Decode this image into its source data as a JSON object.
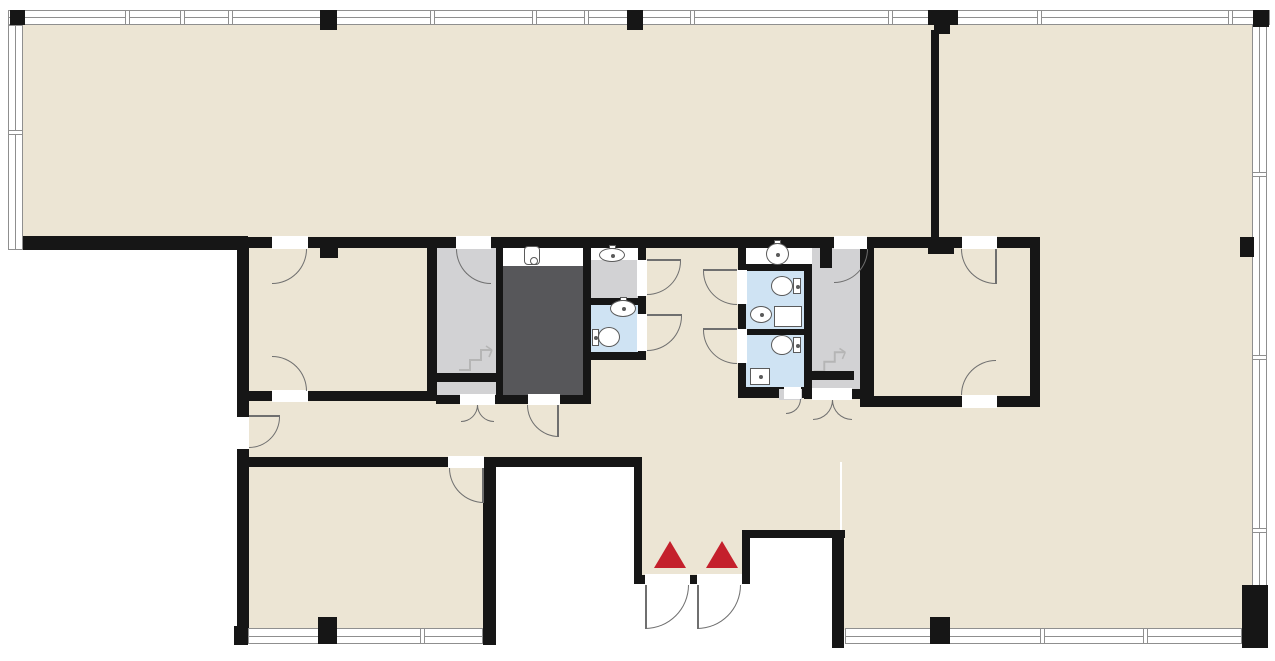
{
  "document": {
    "type": "architectural-floor-plan",
    "visible_text": []
  },
  "colors": {
    "background": "#ffffff",
    "floor": "#ece5d4",
    "wall": "#161616",
    "stair_room": "#d2d2d4",
    "service_shaft": "#57575a",
    "restroom": "#cfe3f3",
    "fixture_fill": "#ffffff",
    "fixture_line": "#5a5a5a",
    "door_line": "#6f6f6f",
    "window_line": "#8f8f8f",
    "entrance_marker": "#c4202c",
    "stair_mark": "#b5b5b5"
  },
  "legend": {
    "entrance_markers": 2,
    "door_swings": 20,
    "toilets": 3,
    "wash_basins": 5,
    "urinals": 1,
    "stairwells": 2,
    "service_shafts": 1,
    "restrooms": 3,
    "window_bands": 5
  }
}
